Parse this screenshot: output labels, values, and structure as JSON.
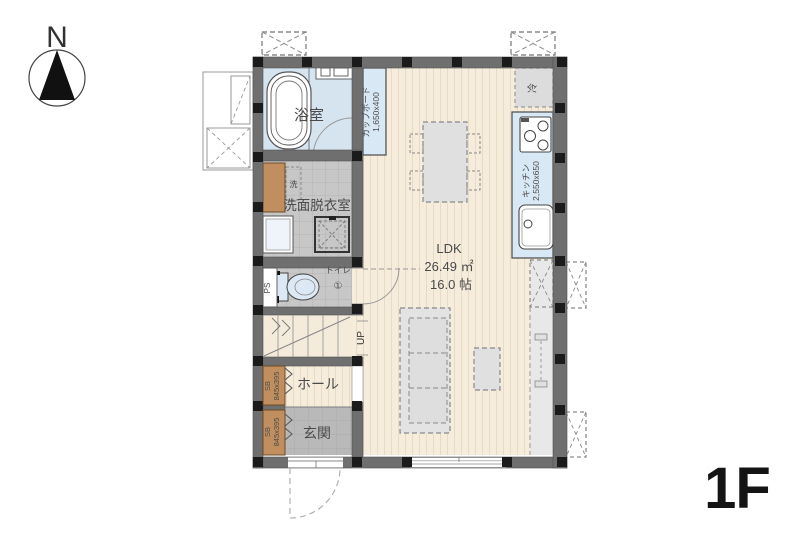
{
  "compass": {
    "north": "N"
  },
  "floor_label": "1F",
  "rooms": {
    "bathroom": "浴室",
    "washroom": "洗面脱衣室",
    "toilet": "トイレ",
    "toilet_no": "①",
    "hall": "ホール",
    "entrance": "玄関",
    "ldk_name": "LDK",
    "ldk_area_m2": "26.49 ㎡",
    "ldk_area_jo": "16.0 帖"
  },
  "labels": {
    "cupboard": "カップボード",
    "cupboard_size": "1,650x400",
    "kitchen": "キッチン",
    "kitchen_size": "2,550x650",
    "refrigerator": "冷",
    "washer": "洗",
    "shoe_box": "SB",
    "shoe_box_size": "845x395",
    "pipe_space": "PS",
    "stairs_up": "UP"
  },
  "colors": {
    "wall": "#6f6f6f",
    "pillar": "#1b1b1b",
    "wood_floor": "#f5ecdc",
    "tile_floor": "#c7c7c7",
    "water_fixture": "#d8e8f5",
    "shoe_box": "#c18f5f",
    "entrance_floor": "#b9b9b9"
  }
}
